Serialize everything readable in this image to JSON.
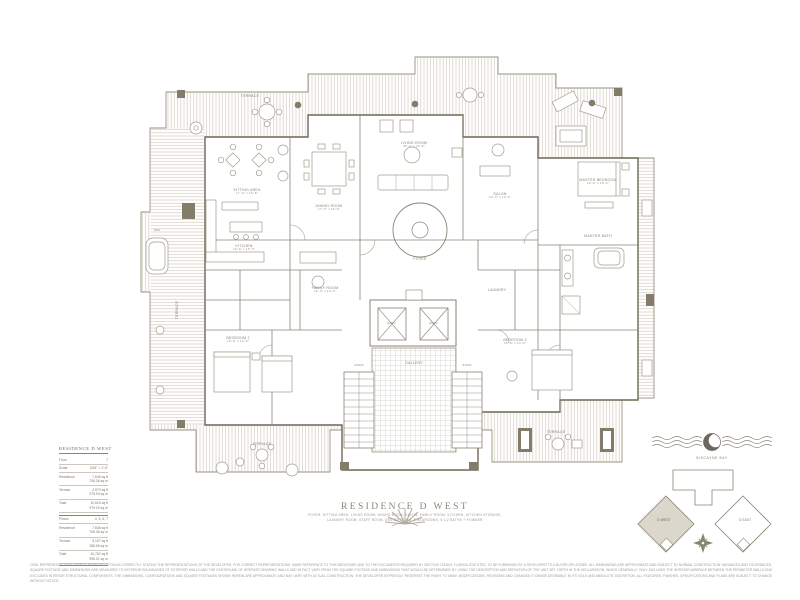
{
  "colors": {
    "line": "#8b8374",
    "wall": "#6e6757",
    "hatch": "#cfcabf",
    "dark": "#847c6b",
    "keyfill": "#dbd7cb",
    "title": "#8d8476"
  },
  "title_block": {
    "title": "RESIDENCE D WEST",
    "features_line1": "FOYER, SITTING AREA, LIVING ROOM, DINING ROOM, SALON, FAMILY ROOM, KITCHEN, KITCHEN STORAGE,",
    "features_line2": "LAUNDRY ROOM, STAFF ROOM, DESIGN ROOM, 5 BEDROOMS, 5 1/2 BATHS + POWDER"
  },
  "info_panel": {
    "title": "RESIDENCE D WEST",
    "rows": [
      {
        "l": "Floor",
        "v": "7",
        "v2": ""
      },
      {
        "l": "Scale",
        "v": "3/16\" = 1'-0\"",
        "v2": ""
      },
      {
        "l": "Residence",
        "v": "7,645 sq ft",
        "v2": "706.36 sq m"
      },
      {
        "l": "Terrace",
        "v": "2,970 sq ft",
        "v2": "275.93 sq m"
      },
      {
        "l": "Total",
        "v": "10,615 sq ft",
        "v2": "979.29 sq m"
      },
      {
        "l": "Floors",
        "v": "4, 5, 6, 7",
        "v2": ""
      },
      {
        "l": "Residence",
        "v": "7,645 sq ft",
        "v2": "706.36 sq m"
      },
      {
        "l": "Terrace",
        "v": "3,107 sq ft",
        "v2": "288.65 sq m"
      },
      {
        "l": "Total",
        "v": "10,752 sq ft",
        "v2": "995.01 sq m"
      }
    ]
  },
  "emblem": {
    "caption": "BISCAYNE BAY"
  },
  "key_plan": {
    "left_label": "D WEST",
    "right_label": "D EAST"
  },
  "rooms": {
    "terrace": {
      "name": "TERRACE"
    },
    "sitting": {
      "name": "SITTING AREA",
      "dims": "17'-4\" x 16'-8\""
    },
    "dining": {
      "name": "DINING ROOM",
      "dims": "17'-0\" x 16'-8\""
    },
    "living": {
      "name": "LIVING ROOM",
      "dims": "25'-4\" x 22'-0\""
    },
    "study": {
      "name": "SALON",
      "dims": "14'-0\" x 12'-6\""
    },
    "kitchen": {
      "name": "KITCHEN",
      "dims": "19'-6\" x 15'-0\""
    },
    "family": {
      "name": "FAMILY ROOM",
      "dims": "16'-0\" x 14'-6\""
    },
    "master": {
      "name": "MASTER BEDROOM",
      "dims": "19'-0\" x 16'-0\""
    },
    "masterbath": {
      "name": "MASTER BATH"
    },
    "bed2": {
      "name": "BEDROOM 2",
      "dims": "16'-0\" x 14'-0\""
    },
    "bed3": {
      "name": "BEDROOM 3",
      "dims": "15'-6\" x 14'-0\""
    },
    "foyer": {
      "name": "FOYER"
    },
    "gallery": {
      "name": "GALLERY"
    },
    "laundry": {
      "name": "LAUNDRY"
    },
    "spa": {
      "name": "SPA"
    },
    "elev": {
      "name": "ELEV."
    },
    "stair": {
      "name": "STAIR"
    }
  },
  "disclaimer": "ORAL REPRESENTATIONS CANNOT BE RELIED UPON AS CORRECTLY STATING THE REPRESENTATIONS OF THE DEVELOPER. FOR CORRECT REPRESENTATIONS, MAKE REFERENCE TO THIS BROCHURE AND TO THE DOCUMENTS REQUIRED BY SECTION 718.503, FLORIDA STATUTES, TO BE FURNISHED BY A DEVELOPER TO A BUYER OR LESSEE. ALL DIMENSIONS ARE APPROXIMATE AND SUBJECT TO NORMAL CONSTRUCTION VARIANCES AND TOLERANCES. SQUARE FOOTAGE AND DIMENSIONS ARE MEASURED TO EXTERIOR BOUNDARIES OF EXTERIOR WALLS AND THE CENTERLINE OF INTERIOR DEMISING WALLS AND IN FACT VARY FROM THE SQUARE FOOTAGE AND DIMENSIONS THAT WOULD BE DETERMINED BY USING THE DESCRIPTION AND DEFINITION OF THE UNIT SET FORTH IN THE DECLARATION, WHICH GENERALLY ONLY INCLUDES THE INTERIOR AIRSPACE BETWEEN THE PERIMETER WALLS AND EXCLUDES INTERIOR STRUCTURAL COMPONENTS. THE DIMENSIONS, CONFIGURATIONS AND SQUARE FOOTAGES SHOWN HEREIN ARE APPROXIMATE AND MAY VARY WITH ACTUAL CONSTRUCTION. THE DEVELOPER EXPRESSLY RESERVES THE RIGHT TO MAKE MODIFICATIONS, REVISIONS AND CHANGES IT DEEMS DESIRABLE IN ITS SOLE AND ABSOLUTE DISCRETION. ALL FEATURES, FINISHES, SPECIFICATIONS AND PLANS ARE SUBJECT TO CHANGE WITHOUT NOTICE."
}
